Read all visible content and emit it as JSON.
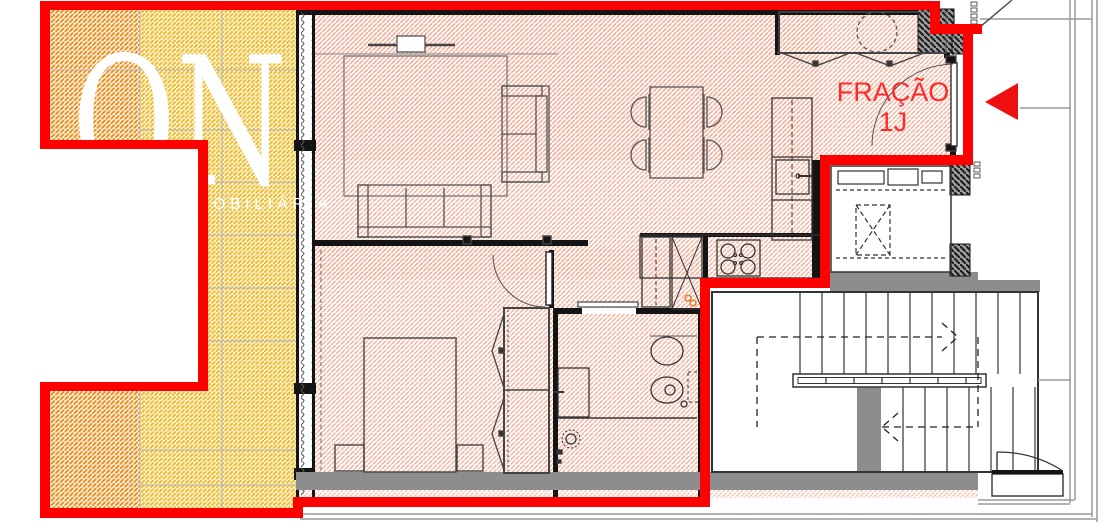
{
  "labels": {
    "fraction_line1": "FRAÇÃO",
    "fraction_line2": "1J"
  },
  "watermark": {
    "brand": "ON",
    "tagline": "MEDIAÇÃO IMOBILIÁRIA"
  },
  "colors": {
    "boundary": "#ff0000",
    "label": "#ff2a2a",
    "arrow": "#ee1010",
    "balcony_orange": "#ef8f1c",
    "balcony_yellow": "#f0bf35",
    "floor_pink": "#f2b09a",
    "wall_black": "#141414",
    "wall_gray": "#8d8d8d",
    "line_gray": "#9a9a9a",
    "watermark": "#ffffff"
  }
}
